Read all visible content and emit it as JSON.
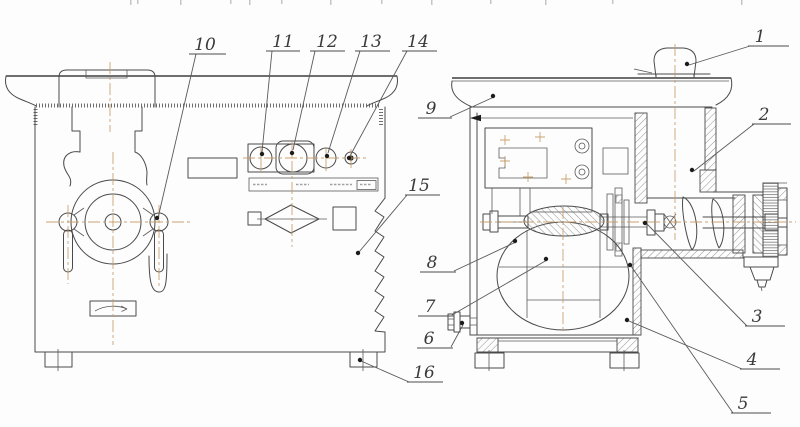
{
  "figure": {
    "type": "technical-drawing",
    "background_color": "#fdfdfd",
    "line_color": "#4a4a4a",
    "centerline_color": "#c49a62",
    "views": [
      {
        "name": "front-view"
      },
      {
        "name": "side-section-view"
      }
    ],
    "callouts": [
      {
        "label": "1"
      },
      {
        "label": "2"
      },
      {
        "label": "3"
      },
      {
        "label": "4"
      },
      {
        "label": "5"
      },
      {
        "label": "6"
      },
      {
        "label": "7"
      },
      {
        "label": "8"
      },
      {
        "label": "9"
      },
      {
        "label": "10"
      },
      {
        "label": "11"
      },
      {
        "label": "12"
      },
      {
        "label": "13"
      },
      {
        "label": "14"
      },
      {
        "label": "15"
      },
      {
        "label": "16"
      }
    ]
  }
}
